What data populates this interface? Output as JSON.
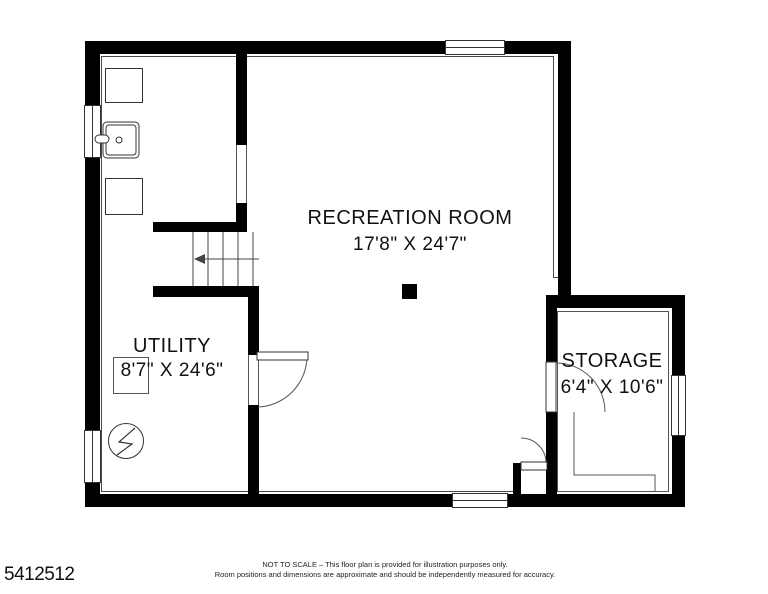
{
  "floor_plan": {
    "rooms": [
      {
        "id": "recreation",
        "name": "RECREATION ROOM",
        "dimensions": "17'8\" X 24'7\""
      },
      {
        "id": "utility",
        "name": "UTILITY",
        "dimensions": "8'7\" X 24'6\""
      },
      {
        "id": "storage",
        "name": "STORAGE",
        "dimensions": "6'4\" X 10'6\""
      }
    ],
    "listing_id": "5412512",
    "footer": {
      "line1": "NOT TO SCALE – This floor plan is provided for illustration purposes only.",
      "line2": "Room positions and dimensions are approximate and should be independently measured for accuracy."
    },
    "colors": {
      "wall": "#000000",
      "background": "#ffffff",
      "thin_line": "#4a4a4a",
      "text": "#111111"
    },
    "symbols": [
      "washer-square",
      "laundry-sink",
      "dryer-square",
      "electrical-panel-circle",
      "stairs-with-direction-arrow",
      "support-column",
      "door-swing-arc",
      "window"
    ]
  }
}
